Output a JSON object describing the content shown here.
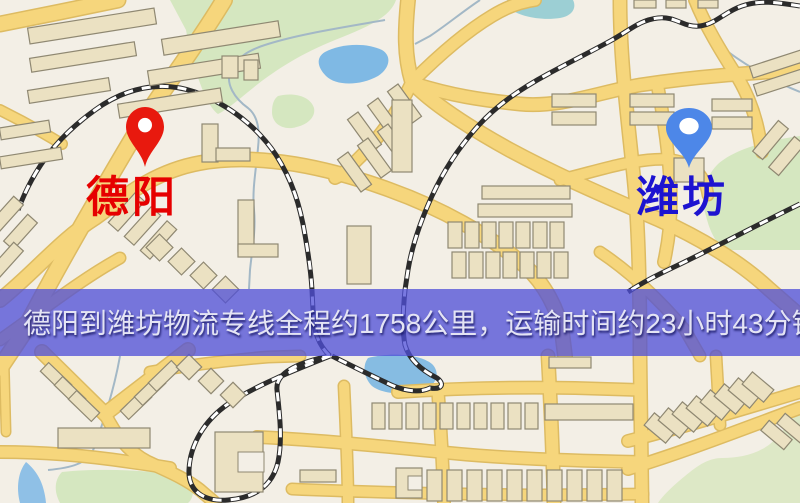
{
  "banner": {
    "text": "德阳到潍坊物流专线全程约1758公里，运输时间约23小时43分钟.",
    "background_color": "#4f4fd8",
    "text_color": "#e4e4f4"
  },
  "markers": {
    "origin": {
      "label": "德阳",
      "label_color": "#e60000",
      "pin_color": "#e8190e"
    },
    "destination": {
      "label": "潍坊",
      "label_color": "#1d13d0",
      "pin_color": "#4d87e8"
    }
  },
  "map_palette": {
    "background": "#f3efe6",
    "road": "#f6d67c",
    "road_casing": "#ddbb62",
    "park": "#d5e7c0",
    "water": "#7fb9e4",
    "railway": "#2b2b2b",
    "building": "#ebe1c2",
    "building_outline": "#8f8872"
  }
}
